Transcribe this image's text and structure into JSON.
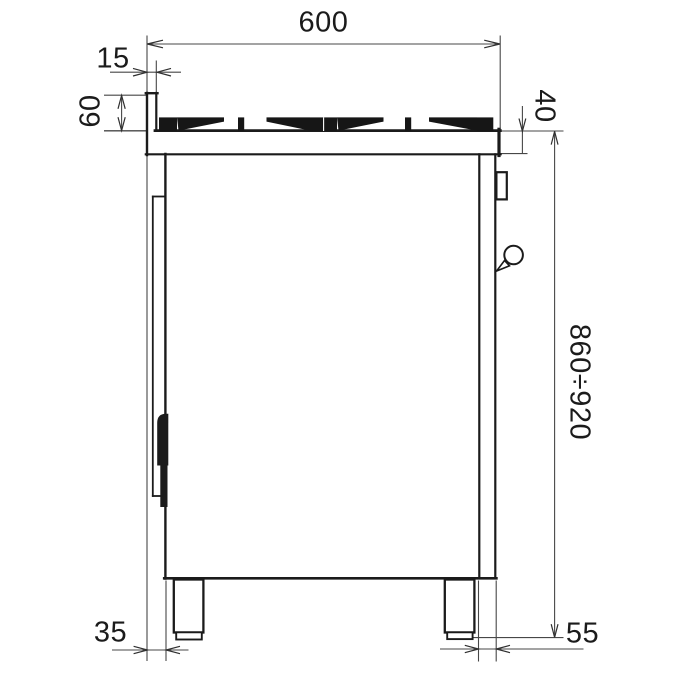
{
  "dimensions": {
    "width_top": "600",
    "back_offset_top": "15",
    "splashback_height": "60",
    "worktop_thickness": "40",
    "overall_height_range": "860÷920",
    "bottom_back_clearance": "35",
    "bottom_front_clearance": "55"
  }
}
